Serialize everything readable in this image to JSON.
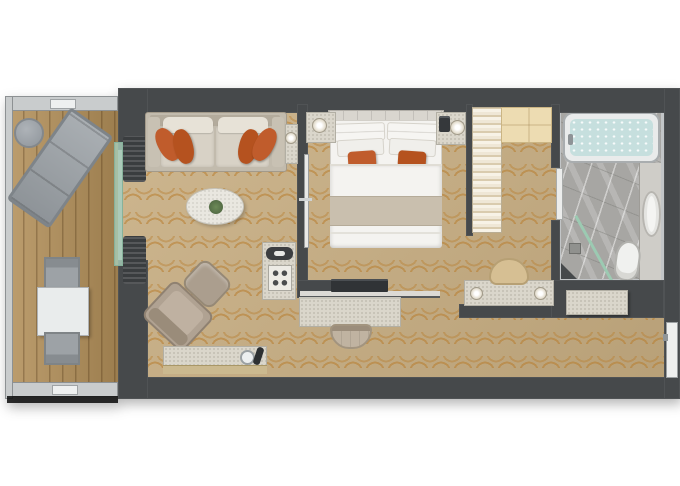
{
  "scene": {
    "type": "floor-plan",
    "rooms": [
      {
        "name": "balcony",
        "items": [
          "railing",
          "sun-lounger",
          "round-side-table",
          "dining-table",
          "chair",
          "chair"
        ]
      },
      {
        "name": "living-room",
        "items": [
          "sofa",
          "orange-throw-pillows",
          "oval-coffee-table",
          "armchair",
          "ottoman",
          "sideboard-with-ice-bucket",
          "minibar-cabinet",
          "side-table-with-lamp",
          "sliding-glass-door",
          "curtains"
        ]
      },
      {
        "name": "bedroom",
        "items": [
          "double-bed",
          "headboard",
          "white-pillows",
          "orange-accent-pillows",
          "nightstand-with-lamp",
          "nightstand-with-lamp-and-phone",
          "tv",
          "tv-shelf",
          "desk",
          "desk-chair",
          "vanity-with-lamps",
          "stool",
          "sliding-door"
        ]
      },
      {
        "name": "walk-in-closet",
        "items": [
          "hanging-rail",
          "shelving-unit"
        ]
      },
      {
        "name": "bathroom",
        "items": [
          "bathtub",
          "washbasin",
          "vanity-counter",
          "toilet",
          "shower",
          "glass-screen",
          "floor-drain",
          "door"
        ]
      },
      {
        "name": "hallway",
        "items": [
          "console-shelf",
          "entry-door"
        ]
      }
    ]
  },
  "colors": {
    "wall": "#46494b",
    "carpet": "#c8ae82",
    "carpet_pattern": "#b87d2e",
    "deck_wood": "#b28f59",
    "railing": "#c9cccd",
    "glass": "#a9cfba",
    "curtain": "#3a3d3f",
    "marble": "#dad6cb",
    "sofa": "#c2bbad",
    "sofa_cushion": "#d8d2c6",
    "pillow_white": "#f6f5f2",
    "accent_orange": "#c05c2c",
    "accent_orange_dark": "#b5521f",
    "bed_linen": "#f4f3f0",
    "bed_runner": "#c9bfae",
    "headboard": "#d9d6cf",
    "taupe_chair": "#ab9e8e",
    "stool_tan": "#d6bf93",
    "closet_wood": "#eddcb2",
    "closet_rail": "#ece4d2",
    "bath_floor": "#a7a6a3",
    "bath_wall": "#c2c5c7",
    "fixture_white": "#f0f1ef",
    "tub_water": "#c6dfde",
    "metal_gray": "#9aa0a4",
    "tv_black": "#303336"
  }
}
